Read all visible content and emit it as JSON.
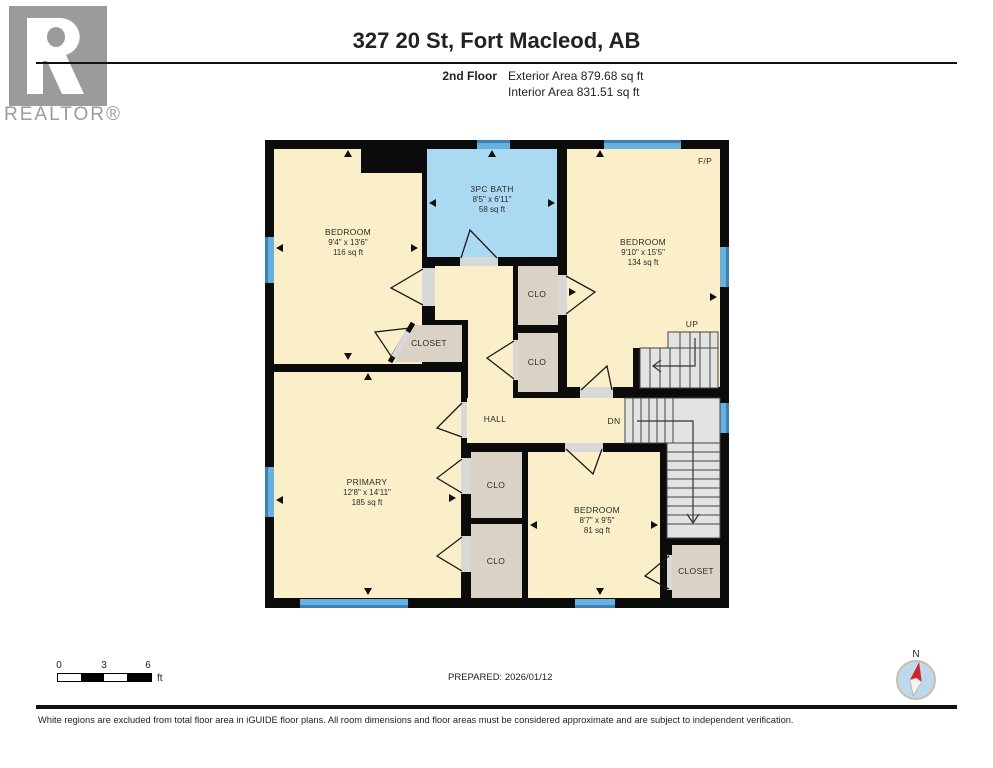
{
  "header": {
    "logo_text": "REALTOR®",
    "title": "327 20 St, Fort Macleod, AB",
    "floor_label": "2nd Floor",
    "exterior_area": "Exterior Area 879.68 sq ft",
    "interior_area": "Interior Area 831.51 sq ft"
  },
  "plan": {
    "rooms": [
      {
        "id": "bedroom-top-left",
        "name": "BEDROOM",
        "dims": "9'4\" x 13'6\"",
        "area": "116 sq ft"
      },
      {
        "id": "bath",
        "name": "3PC BATH",
        "dims": "8'5\" x 6'11\"",
        "area": "58 sq ft"
      },
      {
        "id": "bedroom-top-right",
        "name": "BEDROOM",
        "dims": "9'10\" x 15'5\"",
        "area": "134 sq ft"
      },
      {
        "id": "primary",
        "name": "PRIMARY",
        "dims": "12'8\" x 14'11\"",
        "area": "185 sq ft"
      },
      {
        "id": "bedroom-bottom-right",
        "name": "BEDROOM",
        "dims": "8'7\" x 9'5\"",
        "area": "81 sq ft"
      }
    ],
    "small_labels": {
      "clo": "CLO",
      "closet": "CLOSET",
      "hall": "HALL",
      "up": "UP",
      "dn": "DN",
      "fireplace": "F/P"
    },
    "colors": {
      "room_fill": "#FAEFC9",
      "bath_fill": "#ABD9F1",
      "closet_fill": "#DAD2C4",
      "stairs_fill": "#E3E3E3",
      "wall": "#0B0B0B",
      "window": "#58ABDB"
    }
  },
  "footer": {
    "scale_ticks": [
      "0",
      "3",
      "6"
    ],
    "scale_unit": "ft",
    "prepared": "PREPARED: 2026/01/12",
    "compass_label": "N",
    "disclaimer": "White regions are excluded from total floor area in iGUIDE floor plans. All room dimensions and floor areas must be considered approximate and are subject to independent verification."
  }
}
